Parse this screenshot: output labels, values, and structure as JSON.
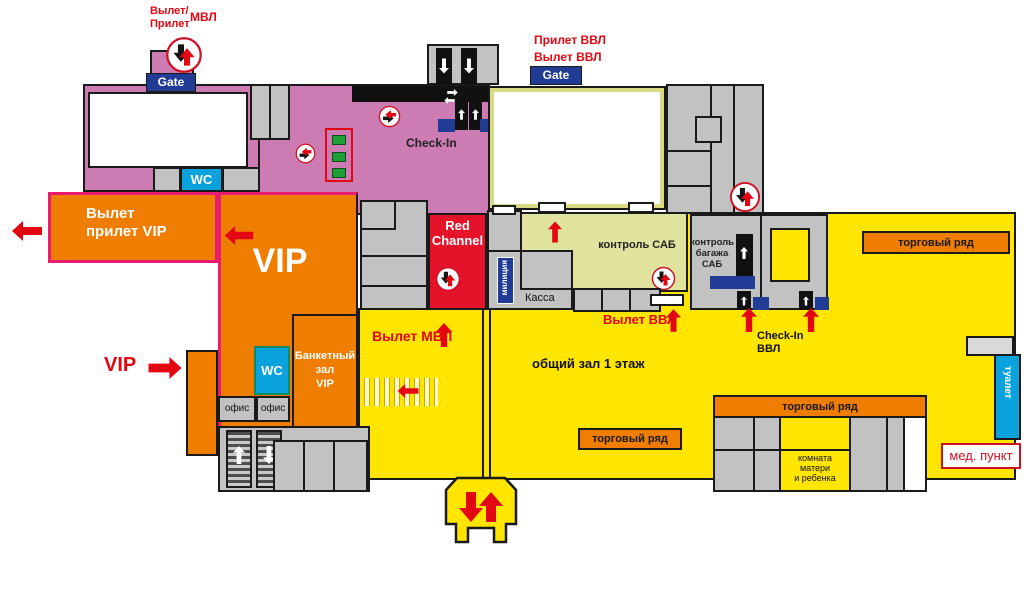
{
  "colors": {
    "international_zone_pink": "#cc7cb2",
    "common_hall_yellow": "#ffe500",
    "vip_orange": "#ee7d00",
    "security_khaki": "#dfe39d",
    "service_gray": "#c2c2c2",
    "red_channel_red": "#e5132a",
    "badge_blue": "#203c94",
    "wc_cyan": "#09a2dc",
    "accent_red": "#e30613",
    "vip_border_pink": "#ea1c70",
    "booth_green": "#1e9e38"
  },
  "icons": {
    "updown_circle": "arrive-depart-updown-circle",
    "leftright_circle": "flow-left-right-circle",
    "red_arrow": "direction-arrow",
    "white_arrow": "escalator-arrow"
  },
  "labels": {
    "mvl_gate_line1": "Вылет/",
    "mvl_gate_line2": "Прилет",
    "mvl": "МВЛ",
    "gate_mvl": "Gate",
    "gate_vvl": "Gate",
    "vvl_arrival": "Прилет ВВЛ",
    "vvl_departure": "Вылет ВВЛ",
    "check_in": "Check-In",
    "wc_gates": "WC",
    "wc_vip": "WC",
    "vip_exit_line1": "Вылет",
    "vip_exit_line2": "прилет VIP",
    "vip_zone": "VIP",
    "vip_entrance": "VIP",
    "banquet_line1": "Банкетный",
    "banquet_line2": "зал",
    "banquet_line3": "VIP",
    "office_1": "офис",
    "office_2": "офис",
    "red_channel_line1": "Red",
    "red_channel_line2": "Channel",
    "militia": "милиция",
    "kassa": "Касса",
    "sab_control": "контроль САБ",
    "baggage_line1": "контроль",
    "baggage_line2": "багажа",
    "baggage_line3": "САБ",
    "vvl_departure_hall": "Вылет ВВЛ",
    "checkin_vvl_line1": "Check-In",
    "checkin_vvl_line2": "ВВЛ",
    "mvl_departure_hall": "Вылет МВЛ",
    "common_hall": "общий зал 1 этаж",
    "trade_row_right": "торговый ряд",
    "trade_row_center": "торговый ряд",
    "trade_row_bottom": "торговый ряд",
    "mother_room_line1": "комната",
    "mother_room_line2": "матери",
    "mother_room_line3": "и ребенка",
    "toilet": "туалет",
    "med_point": "мед. пункт"
  }
}
